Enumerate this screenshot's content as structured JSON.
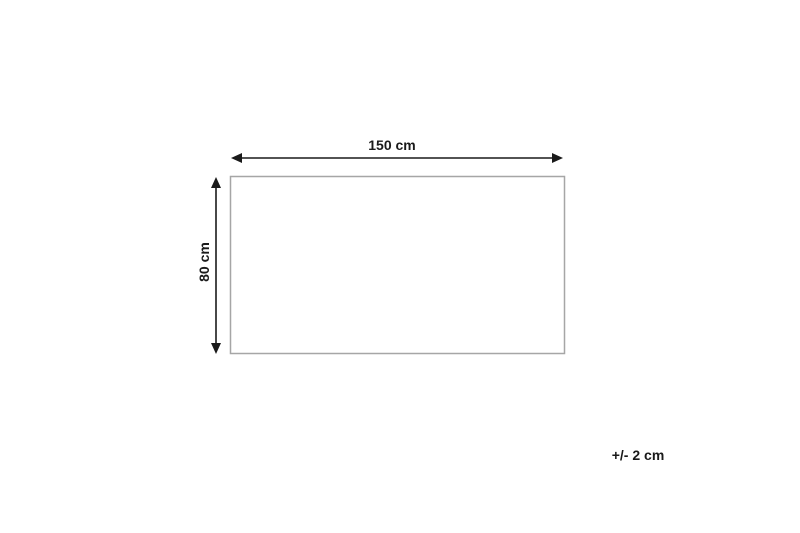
{
  "diagram": {
    "type": "product-dimension-diagram",
    "width_label": "150 cm",
    "height_label": "80 cm",
    "tolerance_label": "+/- 2 cm",
    "arrow_color": "#1a1a1a",
    "text_color": "#1a1a1a",
    "outline_color": "#a6a6a6",
    "shape_fill": "#ffffff"
  }
}
